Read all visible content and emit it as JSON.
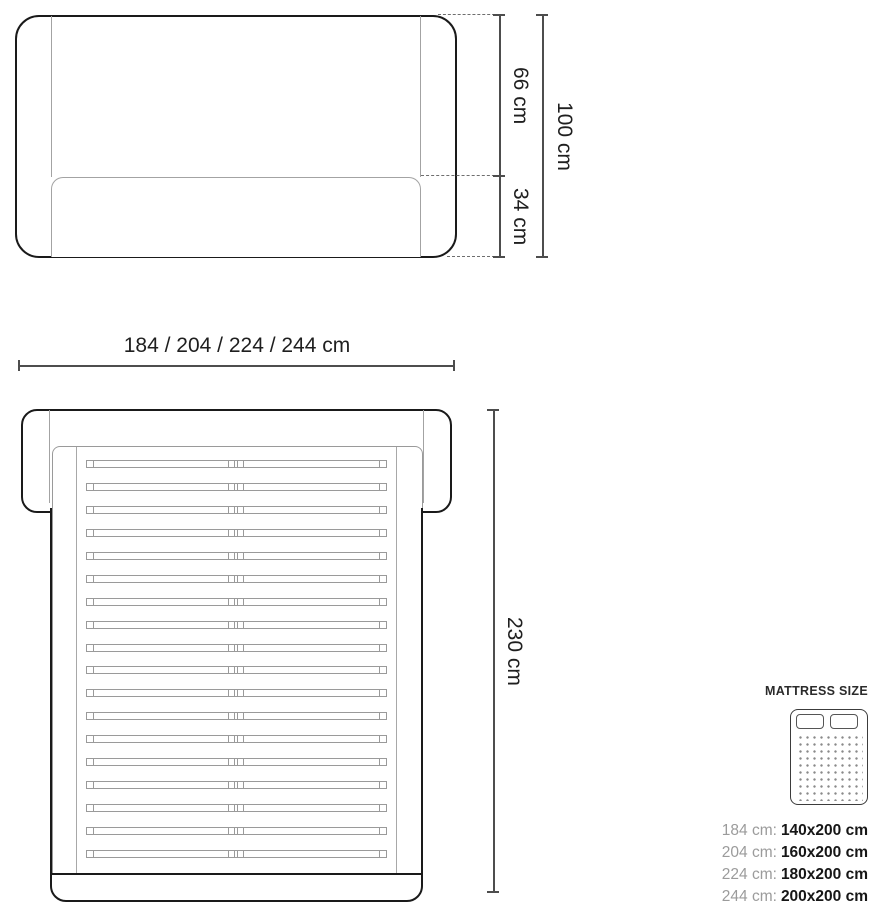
{
  "front_view": {
    "dim_headboard_height": "66 cm",
    "dim_base_height": "34 cm",
    "dim_total_height": "100 cm"
  },
  "width_dimension": {
    "label": "184 / 204 / 224 / 244 cm"
  },
  "top_view": {
    "dim_length": "230 cm",
    "slat_count": 18
  },
  "mattress_panel": {
    "title": "MATTRESS SIZE",
    "rows": [
      {
        "frame": "184 cm:",
        "mattress": "140x200 cm"
      },
      {
        "frame": "204 cm:",
        "mattress": "160x200 cm"
      },
      {
        "frame": "224 cm:",
        "mattress": "180x200 cm"
      },
      {
        "frame": "244 cm:",
        "mattress": "200x200 cm"
      }
    ]
  },
  "colors": {
    "outline_dark": "#1a1a1a",
    "line_gray": "#9a9a9a",
    "dimension_line": "#4d4d4d",
    "text_dark": "#1f1f1f",
    "text_gray": "#9b9b9b"
  }
}
